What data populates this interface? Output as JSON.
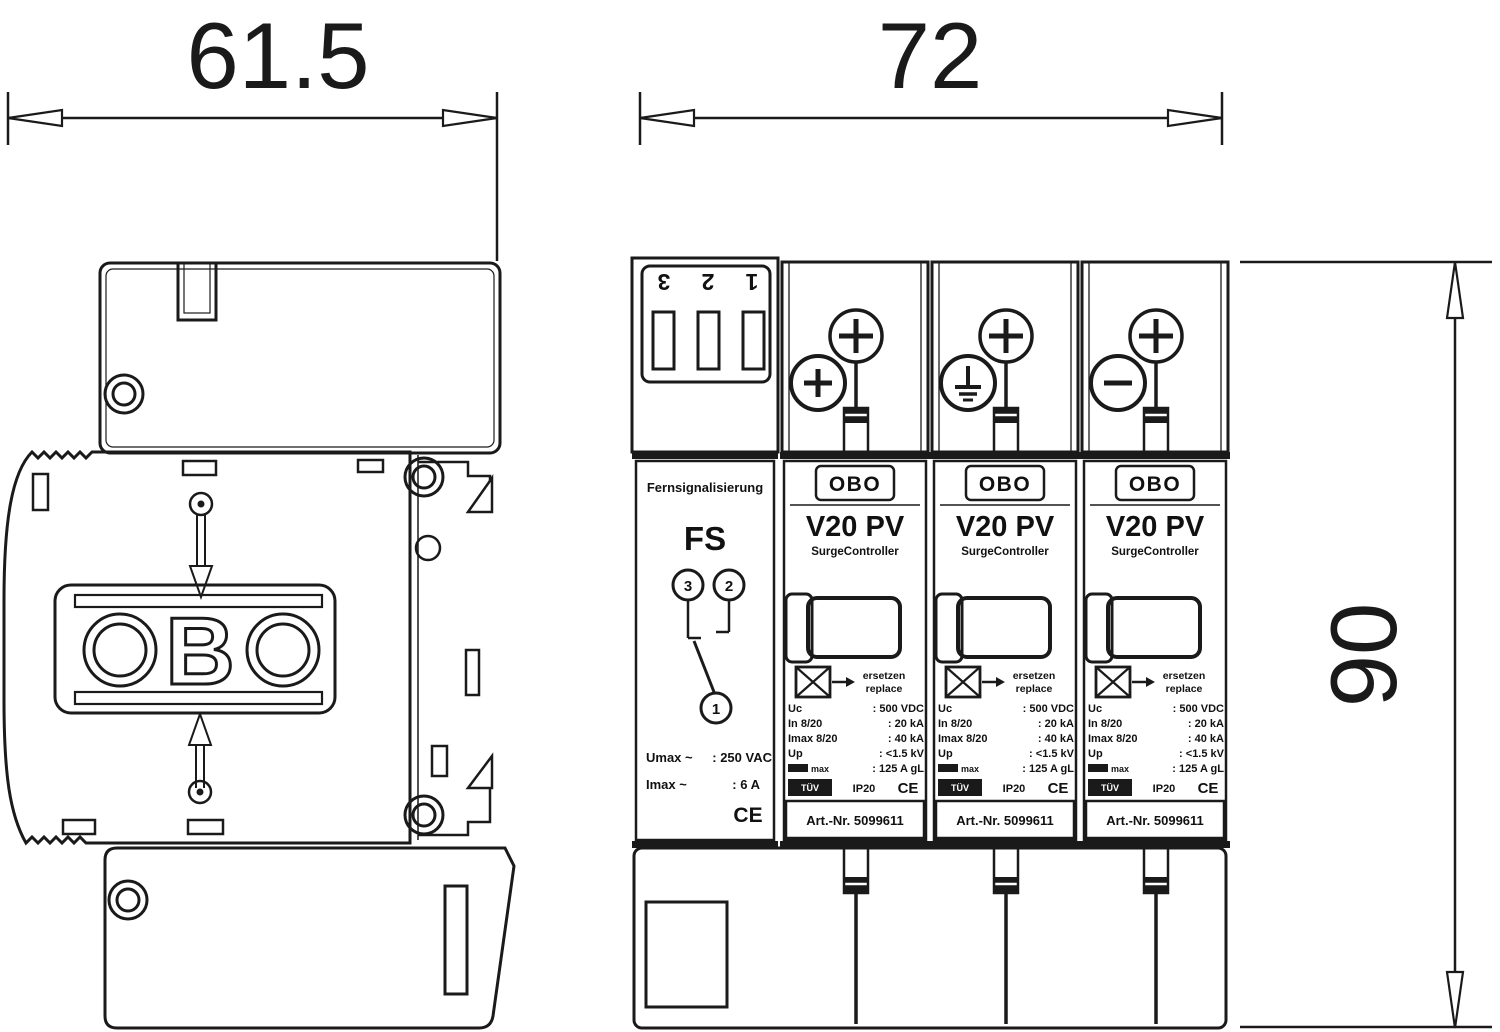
{
  "drawing_title": "Surge protection device dimensional drawing",
  "dimensions": {
    "depth_mm": "61.5",
    "width_mm": "72",
    "height_mm": "90"
  },
  "side_view": {
    "logo_letter_b": "B"
  },
  "front_view": {
    "fs_module": {
      "terminal_numbers": [
        "3",
        "2",
        "1"
      ],
      "title_small": "Fernsignalisierung",
      "title_large": "FS",
      "contact_numbers": {
        "left": "3",
        "right": "2",
        "common": "1"
      },
      "ratings": [
        {
          "label": "Umax ~",
          "value": ": 250 VAC"
        },
        {
          "label": "Imax ~",
          "value": ": 6 A"
        }
      ],
      "ce_mark": "CE"
    },
    "v20_module": {
      "brand": "OBO",
      "model": "V20  PV",
      "subtitle": "SurgeController",
      "replace_text_de": "ersetzen",
      "replace_text_en": "replace",
      "specs": [
        {
          "label": "Uc",
          "value": ": 500 VDC"
        },
        {
          "label": "In 8/20",
          "value": ": 20 kA"
        },
        {
          "label": "Imax 8/20",
          "value": ": 40 kA"
        },
        {
          "label": "Up",
          "value": ": <1.5 kV"
        },
        {
          "label": "max",
          "value": ": 125 A gL"
        }
      ],
      "tuv_mark": "TÜV",
      "ip_rating": "IP20",
      "ce_mark": "CE",
      "article_no": "Art.-Nr. 5099611"
    },
    "module_polarities": [
      "plus",
      "earth",
      "minus"
    ]
  },
  "colors": {
    "line": "#1a1a1a",
    "background": "#ffffff"
  }
}
